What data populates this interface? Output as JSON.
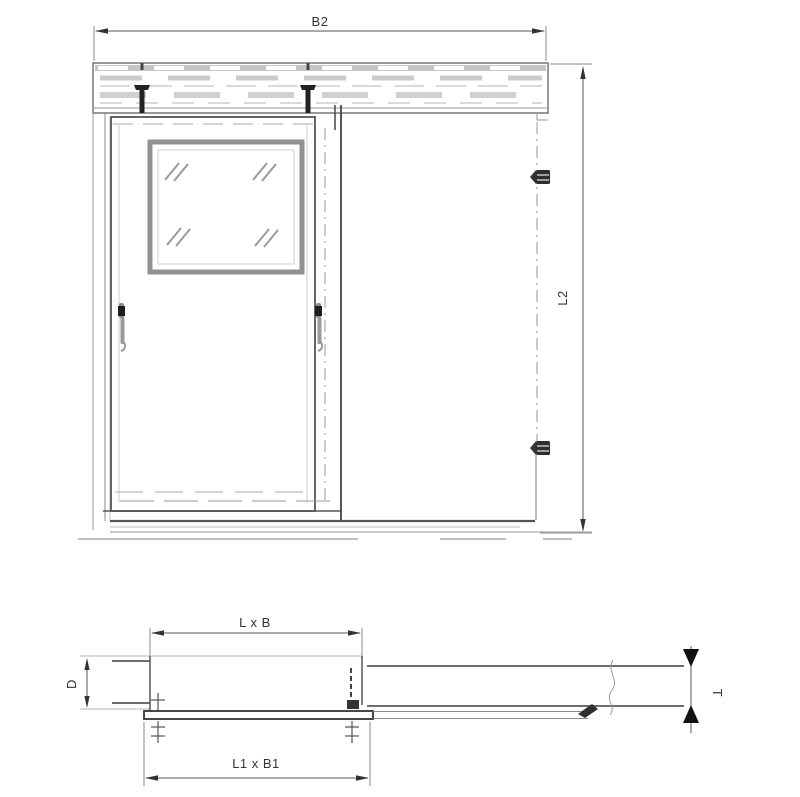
{
  "drawing": {
    "type": "technical-drawing",
    "subject": "sliding cold-room door, front elevation and horizontal section",
    "labels": {
      "b2": "B2",
      "l2": "L2",
      "lxb": "L x B",
      "l1xb1": "L1 x B1",
      "d": "D",
      "t": "T"
    },
    "colors": {
      "background": "#ffffff",
      "line_dark": "#2e2e2e",
      "line_mid": "#6f6f6f",
      "line_light": "#b5b5b5",
      "text": "#333333"
    }
  }
}
